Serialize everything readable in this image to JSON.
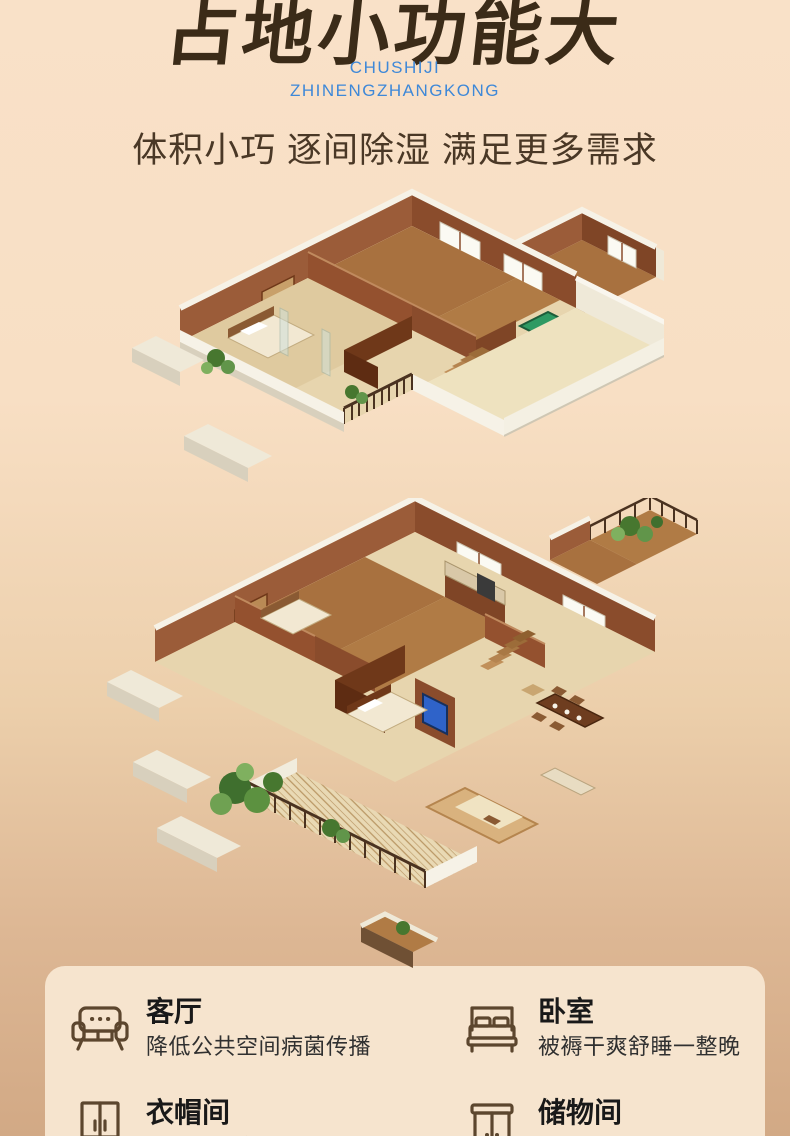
{
  "hero": {
    "title_cn": "占地小功能大",
    "pinyin_line1": "CHUSHIJI",
    "pinyin_line2": "ZHINENGZHANGKONG",
    "tagline": "体积小巧 逐间除湿 满足更多需求"
  },
  "colors": {
    "accent_blue": "#3e88d8",
    "title_brown": "#3b2b18",
    "bg_top": "#f9e1c8",
    "bg_bottom": "#d2a985",
    "card_bg": "#f6e4ce",
    "icon_brown": "#5c462e"
  },
  "features": [
    {
      "icon": "sofa-icon",
      "title": "客厅",
      "desc": "降低公共空间病菌传播"
    },
    {
      "icon": "bed-icon",
      "title": "卧室",
      "desc": "被褥干爽舒睡一整晚"
    },
    {
      "icon": "wardrobe-icon",
      "title": "衣帽间",
      "desc": "除湿防霉全方位呵护"
    },
    {
      "icon": "cabinet-icon",
      "title": "储物间",
      "desc": "储物不受潮防虫防霉"
    }
  ]
}
